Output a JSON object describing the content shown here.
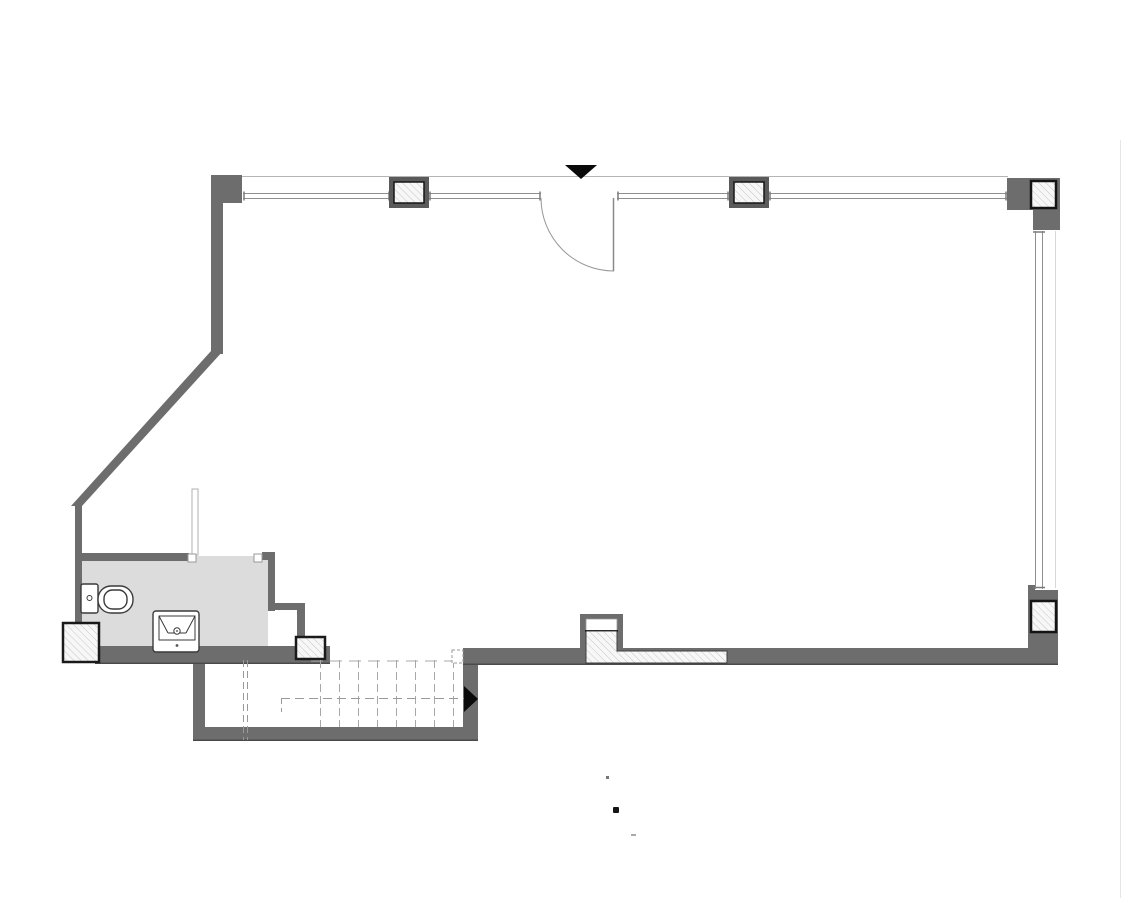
{
  "document": {
    "kind": "architectural-floor-plan",
    "background": "#ffffff"
  },
  "palette": {
    "wall": "#6d6d6d",
    "wall_edge": "#4a4a4a",
    "column_frame": "#5a5a5a",
    "column_border": "#1a1a1a",
    "hatch_bg": "#f7f7f7",
    "hatch_line": "#c6c6c6",
    "bathroom_floor": "#dcdcdc",
    "band_line": "#b5b5b5",
    "window_line": "#8f8f8f",
    "window_faint": "#d8d8d8",
    "door_line": "#979797",
    "dash_line": "#a8a8a8",
    "fixture_line": "#3a3a3a",
    "marker_black": "#0a0a0a"
  },
  "plan": {
    "rooms": [
      {
        "name": "main-room"
      },
      {
        "name": "bathroom"
      },
      {
        "name": "stairwell"
      }
    ],
    "fixtures": [
      {
        "name": "toilet"
      },
      {
        "name": "sink"
      }
    ],
    "windows": [
      {
        "name": "top-window-band"
      },
      {
        "name": "right-window-band"
      }
    ],
    "openings": [
      {
        "name": "entry-door",
        "type": "swing-door"
      },
      {
        "name": "bathroom-door-opening",
        "type": "open-doorway"
      }
    ],
    "columns": {
      "count": 6
    },
    "stairs": {
      "tread_lines": 8,
      "direction_arrow": "right"
    },
    "markers": [
      {
        "name": "entry-marker",
        "shape": "triangle-down"
      },
      {
        "name": "stair-direction-arrow",
        "shape": "triangle-right"
      }
    ]
  }
}
